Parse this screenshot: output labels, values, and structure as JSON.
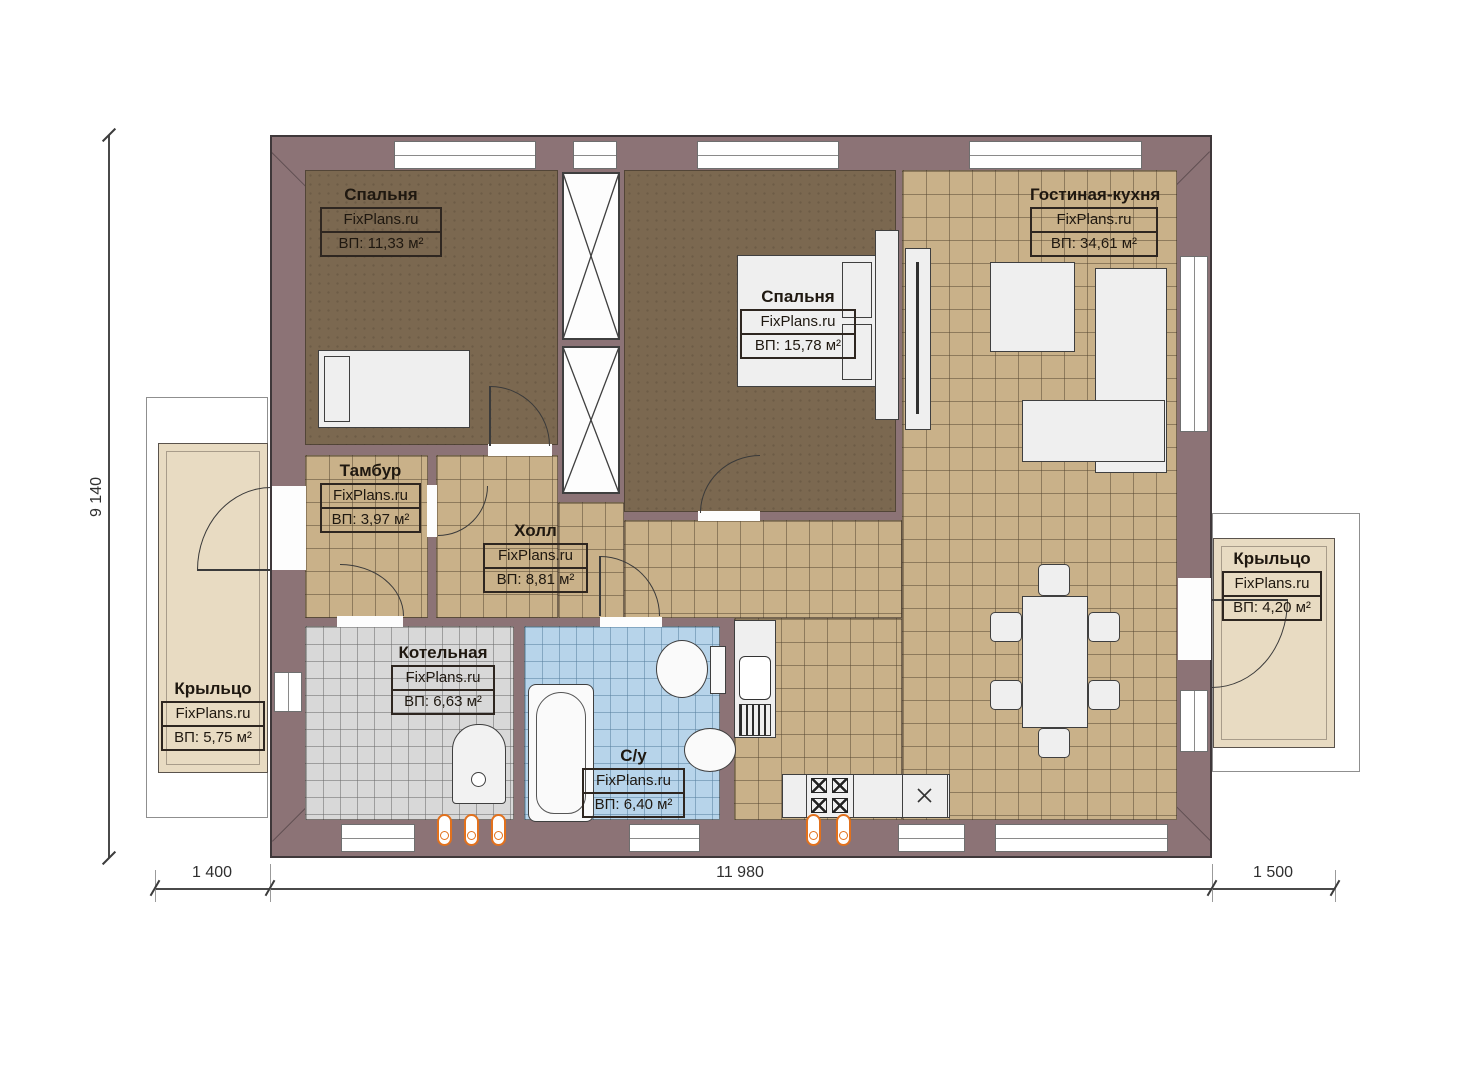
{
  "rooms": {
    "bedroom1": {
      "name": "Спальня",
      "brand": "FixPlans.ru",
      "area": "ВП: 11,33 м²"
    },
    "bedroom2": {
      "name": "Спальня",
      "brand": "FixPlans.ru",
      "area": "ВП: 15,78 м²"
    },
    "living_kitchen": {
      "name": "Гостиная-кухня",
      "brand": "FixPlans.ru",
      "area": "ВП: 34,61 м²"
    },
    "tambour": {
      "name": "Тамбур",
      "brand": "FixPlans.ru",
      "area": "ВП: 3,97 м²"
    },
    "hall": {
      "name": "Холл",
      "brand": "FixPlans.ru",
      "area": "ВП: 8,81 м²"
    },
    "boiler": {
      "name": "Котельная",
      "brand": "FixPlans.ru",
      "area": "ВП: 6,63 м²"
    },
    "bathroom": {
      "name": "С/у",
      "brand": "FixPlans.ru",
      "area": "ВП: 6,40 м²"
    },
    "porch_left": {
      "name": "Крыльцо",
      "brand": "FixPlans.ru",
      "area": "ВП: 5,75 м²"
    },
    "porch_right": {
      "name": "Крыльцо",
      "brand": "FixPlans.ru",
      "area": "ВП: 4,20 м²"
    }
  },
  "dimensions": {
    "left_height": "9 140",
    "bottom_left": "1 400",
    "bottom_center": "11 980",
    "bottom_right": "1 500"
  },
  "colors": {
    "wall": "#8c7376",
    "floor_wood": "#7b6850",
    "floor_tile": "#c9b189",
    "floor_boiler": "#d8d8d8",
    "floor_bath": "#b7d4ea",
    "porch": "#e8dbc2",
    "radiator": "#e2711d"
  }
}
